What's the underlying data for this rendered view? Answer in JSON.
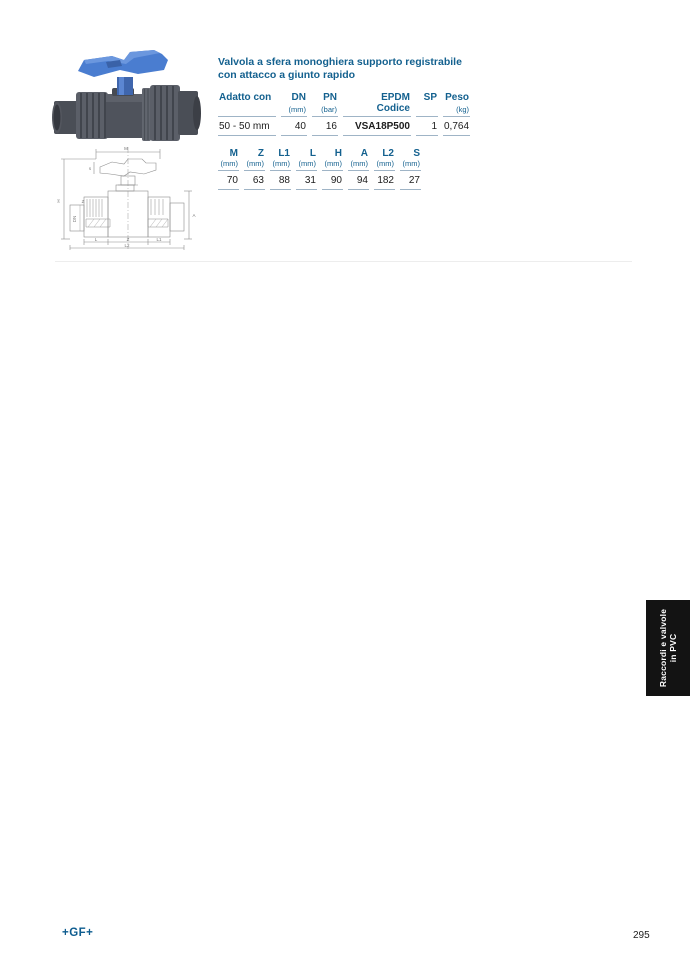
{
  "product": {
    "title_line1": "Valvola a sfera monoghiera supporto registrabile",
    "title_line2": "con attacco a giunto rapido",
    "photo_alt": "ball-valve-blue-handle"
  },
  "colors": {
    "heading_blue": "#14618f",
    "table_rule": "#9fb4c6",
    "tab_black": "#131313",
    "handle_blue": "#4a7dd0",
    "body_grey": "#53565e"
  },
  "table1": {
    "headers": [
      {
        "label": "Adatto con",
        "unit": ""
      },
      {
        "label": "DN",
        "unit": "(mm)"
      },
      {
        "label": "PN",
        "unit": "(bar)"
      },
      {
        "label": "EPDM",
        "unit": "Codice"
      },
      {
        "label": "SP",
        "unit": ""
      },
      {
        "label": "Peso",
        "unit": "(kg)"
      }
    ],
    "row": [
      "50 - 50 mm",
      "40",
      "16",
      "VSA18P500",
      "1",
      "0,764"
    ]
  },
  "table2": {
    "headers": [
      "M",
      "Z",
      "L1",
      "L",
      "H",
      "A",
      "L2",
      "S"
    ],
    "units": [
      "(mm)",
      "(mm)",
      "(mm)",
      "(mm)",
      "(mm)",
      "(mm)",
      "(mm)",
      "(mm)"
    ],
    "row": [
      "70",
      "63",
      "88",
      "31",
      "90",
      "94",
      "182",
      "27"
    ]
  },
  "drawing": {
    "labels": {
      "m": "M",
      "s": "s",
      "h": "H",
      "z": "Z",
      "dn": "DN",
      "l": "L",
      "z2": "Z",
      "l1": "L1",
      "a": "A",
      "l2": "L2"
    }
  },
  "side_tab": {
    "line1": "Raccordi e valvole",
    "line2": "in PVC"
  },
  "footer": {
    "brand": "+GF+",
    "page_number": "295"
  }
}
